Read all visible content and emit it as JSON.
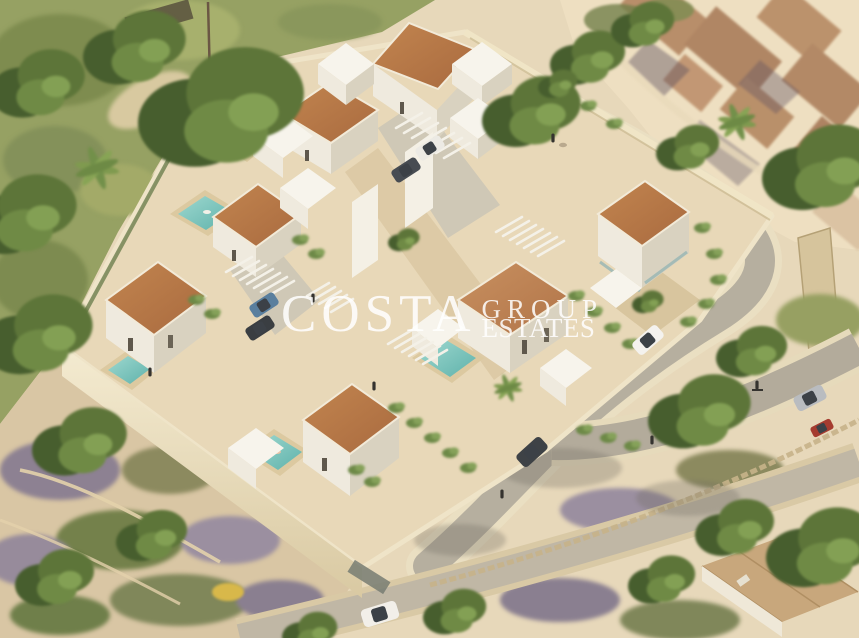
{
  "watermark": {
    "brand": "COSTA",
    "word_top": "GROUP",
    "word_bottom": "ESTATES",
    "color": "#ffffff"
  },
  "scene": {
    "kind": "aerial isometric 3D architectural render",
    "description": "New-build gated development of modern white villas with terracotta mono-pitch tiled roofs, private turquoise pools, pergola carports and landscaped terraces behind cream perimeter walls; a curving access road wraps the east side, with Mediterranean scrubland, mature trees, an old tiled-roof village to the north-east and an existing hip-roofed house to the south-east.",
    "elements": {
      "terracotta_roof_villas": 7,
      "white_flat_roof_volumes": 9,
      "pools": 5,
      "pergola_carports": 5,
      "vehicles": [
        "white SUV on access road",
        "dark SUV on entrance drive",
        "white pickup on lower road",
        "grey car on east road",
        "red car parked east",
        "white and dark cars under central carport",
        "blue and dark cars under west carport"
      ],
      "people": [
        "dog walker on upper road",
        "cyclist on east road",
        "pedestrians on drive and terraces",
        "swimmers in pools"
      ],
      "landscape": [
        "green hillside with large trees (west)",
        "palm trees",
        "old village rooftops (north-east)",
        "purple-green scrubland (south-west)",
        "stone field walls",
        "cascading vines on retaining walls",
        "yellow flowering bush"
      ]
    },
    "palette": {
      "sand": "#e7d8ba",
      "hill_green": "#96a163",
      "tree_dark": "#42582b",
      "tree_mid": "#5d7539",
      "tree_light": "#7b9249",
      "roof_terracotta": "#b4744a",
      "wall_white": "#f8f5ec",
      "wall_shade": "#d8d2c0",
      "perimeter_cream": "#eee3c4",
      "pool_teal": "#74c2ba",
      "road_grey": "#b5ae9f",
      "deck_tan": "#d8bf96",
      "scrub_purple": "#8d8192",
      "village_roof": "#b48a66"
    }
  }
}
